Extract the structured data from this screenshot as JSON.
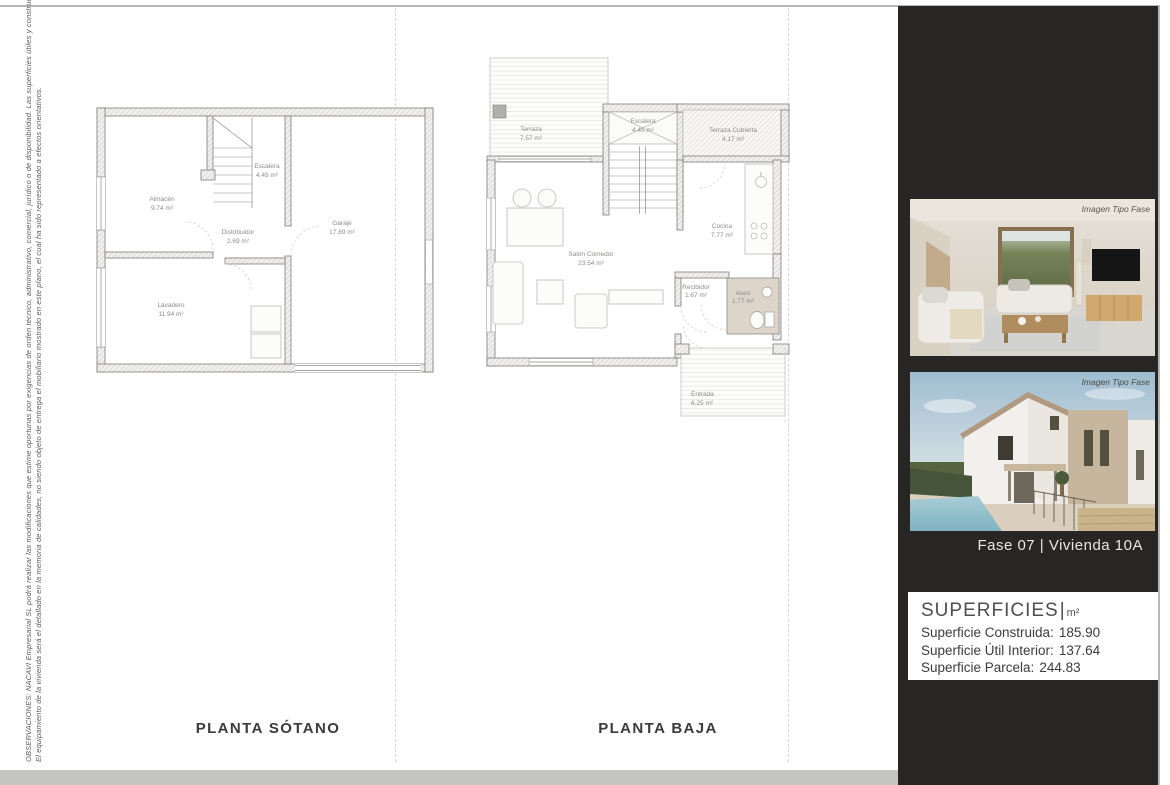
{
  "page": {
    "observations_line1": "OBSERVACIONES: NACAVI Empresarial SL podrá realizar las modificaciones que estime oportunas por exigencias de orden técnico, administrativo, comercial, jurídico o de disponibilidad. Las superficies útiles y constructivas son aproximadas.",
    "observations_line2": "El equipamiento de la vivienda será el detallado en la memoria de calidades, no siendo objeto de entrega el mobiliario mostrado en este plano, el cual ha sido representado a efectos orientativos."
  },
  "plans": {
    "sotano": {
      "title": "PLANTA SÓTANO",
      "rooms": {
        "almacen": {
          "name": "Almacén",
          "area": "9.74 m²"
        },
        "escalera": {
          "name": "Escalera",
          "area": "4.45 m²"
        },
        "distribuidor": {
          "name": "Distribuidor",
          "area": "2.69 m²"
        },
        "lavadero": {
          "name": "Lavadero",
          "area": "11.94 m²"
        },
        "garaje": {
          "name": "Garaje",
          "area": "17.89 m²"
        }
      }
    },
    "baja": {
      "title": "PLANTA BAJA",
      "rooms": {
        "terraza": {
          "name": "Terraza",
          "area": "7.57 m²"
        },
        "escalera": {
          "name": "Escalera",
          "area": "4.45 m²"
        },
        "terraza_cubierta": {
          "name": "Terraza Cubierta",
          "area": "4.17 m²"
        },
        "salon_comedor": {
          "name": "Salón Comedor",
          "area": "23.54 m²"
        },
        "cocina": {
          "name": "Cocina",
          "area": "7.77 m²"
        },
        "recibidor": {
          "name": "Recibidor",
          "area": "1.67 m²"
        },
        "aseo": {
          "name": "Aseo",
          "area": "1.77 m²"
        },
        "entrada": {
          "name": "Entrada",
          "area": "6.25 m²"
        }
      }
    }
  },
  "sidebar": {
    "images": [
      {
        "watermark": "Imagen Tipo Fase",
        "subject": "interior living room render"
      },
      {
        "watermark": "Imagen Tipo Fase",
        "subject": "exterior house render with pool"
      }
    ],
    "unit_label": "Fase 07 |  Vivienda 10A",
    "superficies": {
      "title": "SUPERFICIES",
      "separator": "|",
      "unit": "m²",
      "rows": [
        {
          "label": "Superficie Construida:",
          "value": "185.90"
        },
        {
          "label": "Superficie Útil Interior:",
          "value": "137.64"
        },
        {
          "label": "Superficie Parcela:",
          "value": "244.83"
        }
      ]
    }
  },
  "colors": {
    "sidebar_bg": "#282525",
    "bottom_strip": "#c5c5c3",
    "aseo_fill": "#ddd5ca",
    "pool_blue": "#8fc0cd",
    "sky_blue": "#9fbdd1",
    "hedge_green": "#55633f"
  }
}
